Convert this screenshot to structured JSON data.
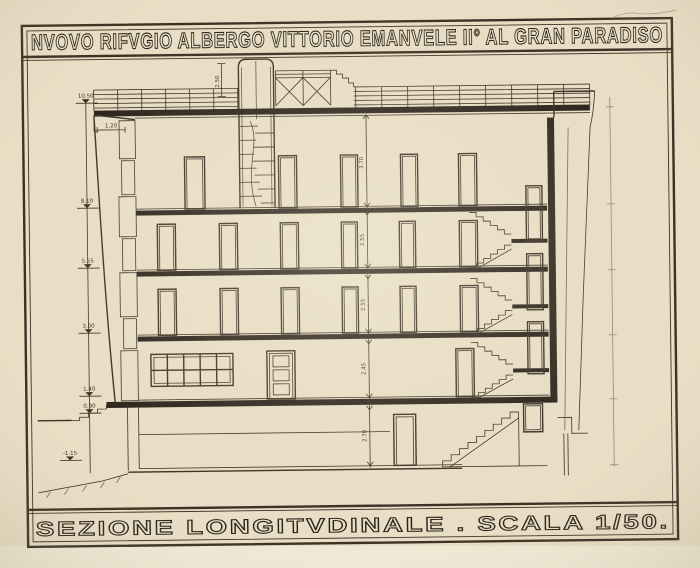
{
  "sheet": {
    "title": "NVOVO RIFVGIO ALBERGO VITTORIO EMANVELE II° AL GRAN PARADISO",
    "caption": "SEZIONE  LONGITVDINALE . SCALA 1/50.",
    "scale": "1/50"
  },
  "drawing": {
    "type": "architectural-section",
    "view": "longitudinal building section with stair tower, roof terrace and side staircase",
    "levels_left": [
      "10.50",
      "8.10",
      "5.55",
      "3.00",
      "1.40",
      "0.90",
      "-1.15"
    ],
    "floor_heights": [
      "3.70",
      "2.55",
      "2.55",
      "2.45",
      "2.70"
    ],
    "parapet_width": "1.20",
    "tower_height": "2.50"
  },
  "colors": {
    "paper": "#e8dec5",
    "ink": "#3a2f24",
    "ink_heavy": "#2a211a"
  }
}
